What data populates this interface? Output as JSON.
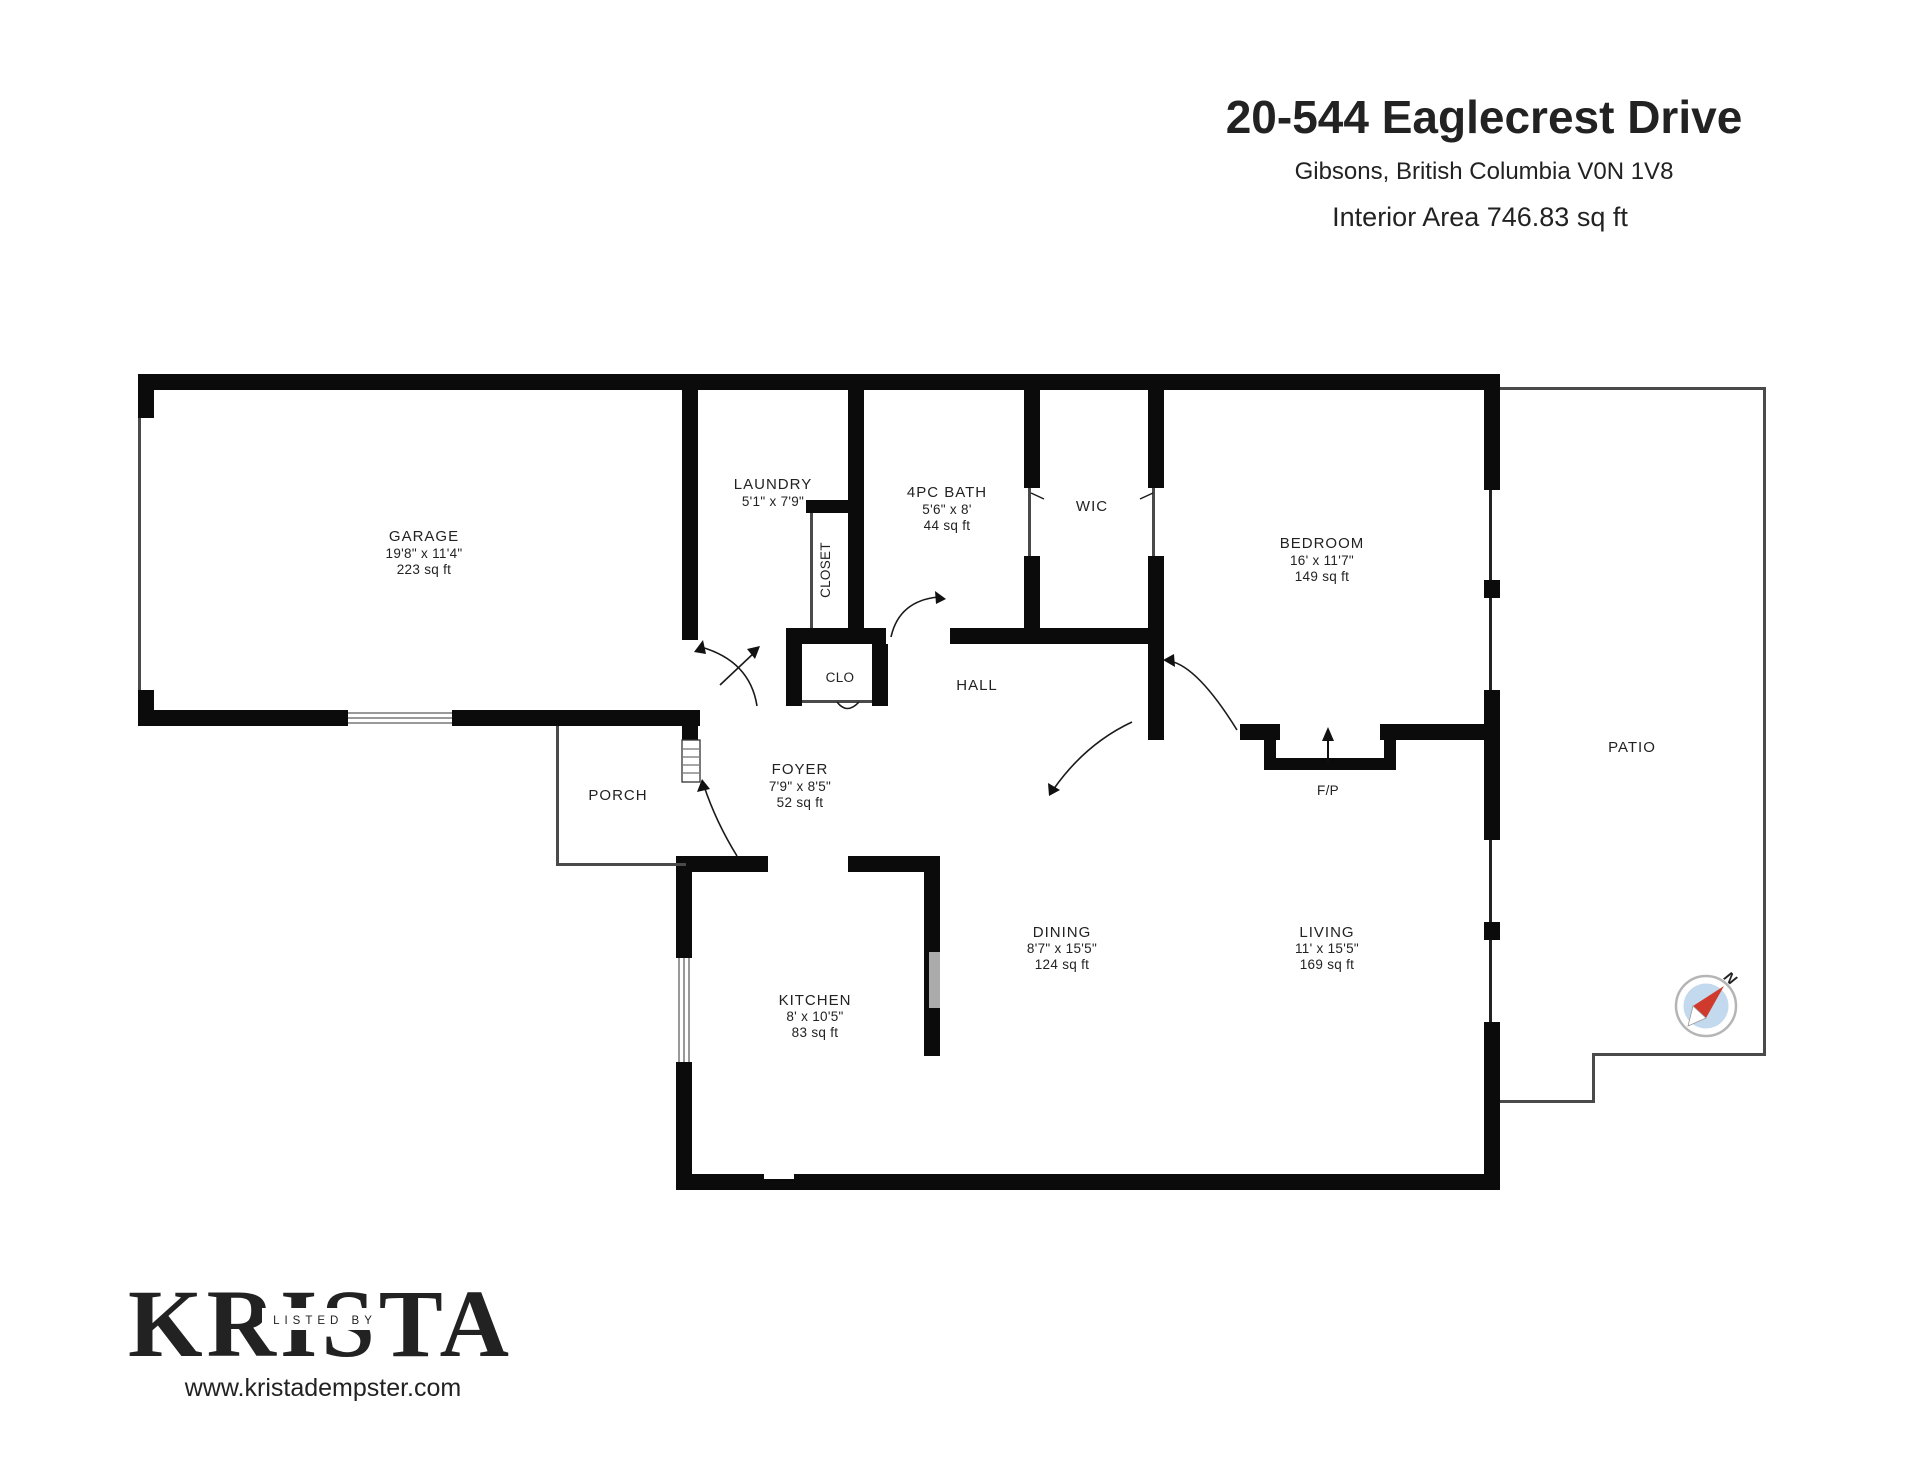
{
  "header": {
    "address": "20-544 Eaglecrest Drive",
    "location": "Gibsons, British Columbia V0N 1V8",
    "interior_area": "Interior Area 746.83 sq ft"
  },
  "plan": {
    "rooms": {
      "garage": {
        "name": "GARAGE",
        "dims": "19'8\" x 11'4\"",
        "area": "223 sq ft"
      },
      "laundry": {
        "name": "LAUNDRY",
        "dims": "5'1\" x 7'9\""
      },
      "closet": {
        "name": "CLOSET"
      },
      "bath": {
        "name": "4PC BATH",
        "dims": "5'6\" x 8'",
        "area": "44 sq ft"
      },
      "wic": {
        "name": "WIC"
      },
      "bedroom": {
        "name": "BEDROOM",
        "dims": "16' x 11'7\"",
        "area": "149 sq ft"
      },
      "clo": {
        "name": "CLO"
      },
      "hall": {
        "name": "HALL"
      },
      "foyer": {
        "name": "FOYER",
        "dims": "7'9\" x 8'5\"",
        "area": "52 sq ft"
      },
      "porch": {
        "name": "PORCH"
      },
      "fireplace": {
        "name": "F/P"
      },
      "kitchen": {
        "name": "KITCHEN",
        "dims": "8' x 10'5\"",
        "area": "83 sq ft"
      },
      "dining": {
        "name": "DINING",
        "dims": "8'7\" x 15'5\"",
        "area": "124 sq ft"
      },
      "living": {
        "name": "LIVING",
        "dims": "11' x 15'5\"",
        "area": "169 sq ft"
      },
      "patio": {
        "name": "PATIO"
      }
    },
    "compass": {
      "north_label": "N"
    }
  },
  "footer": {
    "logo": "KRISTA",
    "logo_tagline": "LISTED BY",
    "website": "www.kristadempster.com"
  },
  "colors": {
    "wall": "#0b0b0b",
    "compass_ring": "#b5b5b5",
    "compass_fill": "#c3d9ee",
    "needle_red": "#cf3a2d"
  }
}
